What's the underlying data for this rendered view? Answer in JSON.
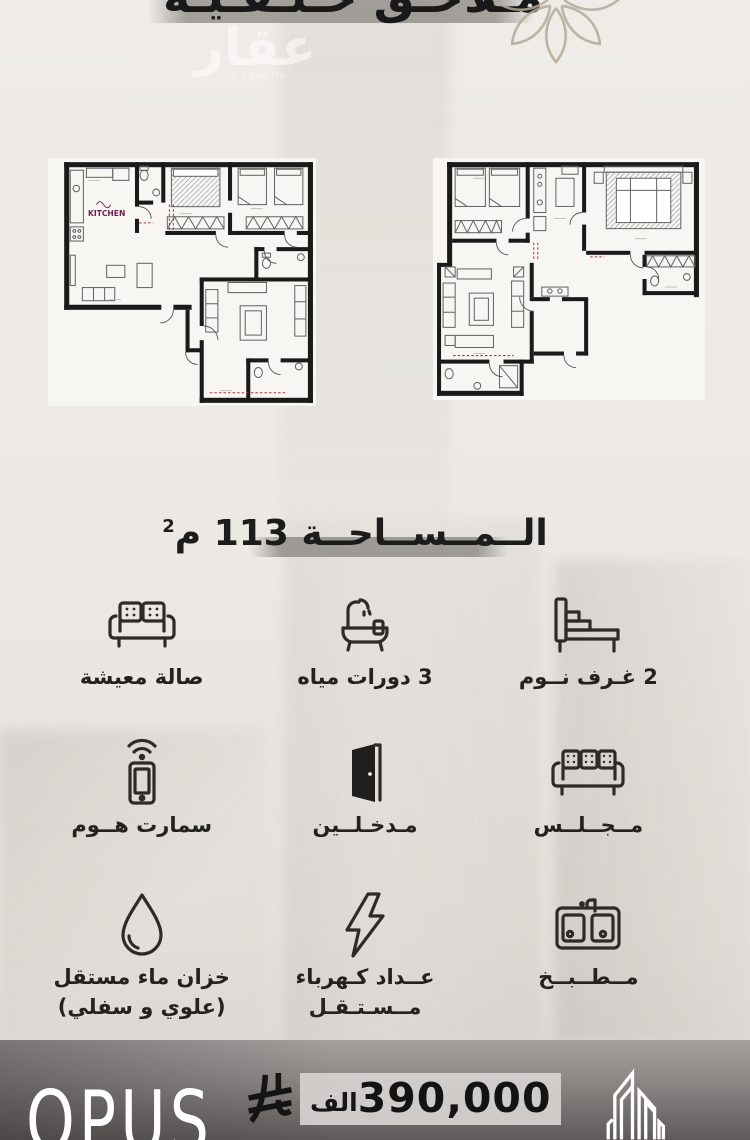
{
  "header": {
    "title": "مـلاحـق خـلـفـيـة",
    "watermark_name": "عقار",
    "watermark_site": "sa.aqar.fm"
  },
  "floorplans": {
    "kitchen_label": "KITCHEN"
  },
  "area": {
    "label": "الــمــســاحــة",
    "value": "113",
    "unit": "م",
    "sup": "2"
  },
  "amenities": [
    {
      "icon": "bed-icon",
      "label": "2 غـرف نــوم"
    },
    {
      "icon": "bathtub-icon",
      "label": "3 دورات مياه"
    },
    {
      "icon": "sofa-icon",
      "label": "صالة معيشة"
    },
    {
      "icon": "majlis-sofa-icon",
      "label": "مــجــلــس"
    },
    {
      "icon": "door-icon",
      "label": "مـدخـلــين"
    },
    {
      "icon": "smart-home-icon",
      "label": "سمارت هــوم"
    },
    {
      "icon": "kitchen-sink-icon",
      "label": "مــطــبــخ"
    },
    {
      "icon": "electric-meter-icon",
      "label": "عــداد كـهرباء",
      "label2": "مــسـتـقـل"
    },
    {
      "icon": "water-tank-icon",
      "label": "خزان ماء مستقل",
      "label2": "(علوي و سفلي)"
    }
  ],
  "footer": {
    "brand": "OPUS",
    "price": "390,000",
    "price_unit": "الف",
    "colors": {
      "accent_purple": "#6d2050",
      "wall_black": "#1a1a1a",
      "band_grey": "#8a8783"
    }
  }
}
